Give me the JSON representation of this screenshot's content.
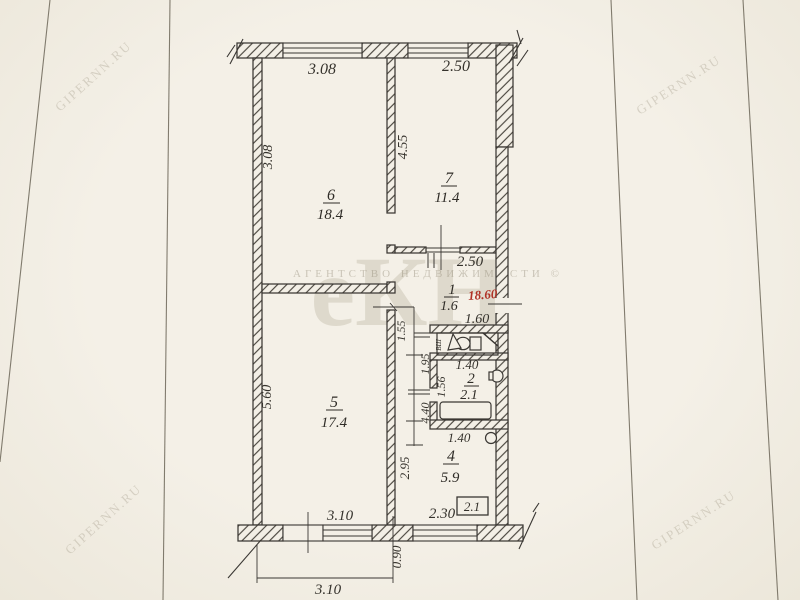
{
  "watermarks": {
    "corner_text": "GIPERNN.RU",
    "agency_text": "АГЕНТСТВО  НЕДВИЖИМОСТИ ©",
    "logo_text": "еКН"
  },
  "red_annotation": "18.60",
  "rooms": {
    "r6": {
      "number": "6",
      "area": "18.4"
    },
    "r7": {
      "number": "7",
      "area": "11.4"
    },
    "r1": {
      "number": "1",
      "area": "1.6"
    },
    "r2": {
      "number": "2",
      "area": "2.1"
    },
    "r5": {
      "number": "5",
      "area": "17.4"
    },
    "r4": {
      "number": "4",
      "area": "5.9"
    }
  },
  "dimensions": {
    "top_room6_width": "3.08",
    "top_room7_width": "2.50",
    "room6_height": "3.08",
    "room7_height": "4.55",
    "hall_width": "2.50",
    "wc_width": "1.60",
    "hall_1_55": "1.55",
    "hall_1_95": "1.95",
    "hall_1_56": "1.56",
    "hall_4_40": "4.40",
    "bath_width": "1.40",
    "kitchen_door_width": "1.40",
    "kitchen_height": "2.95",
    "room5_height": "5.60",
    "bottom_3_10": "3.10",
    "bottom_2_30": "2.30",
    "balcony_area_boxed": "2.1",
    "bottom_offset": "0.90",
    "bottom_total": "3.10"
  },
  "fixtures": {
    "vent_shaft_label": "ВШ"
  },
  "colors": {
    "paper": "#f3efe6",
    "ink": "#3a3733",
    "red_stamp": "#b03226"
  }
}
